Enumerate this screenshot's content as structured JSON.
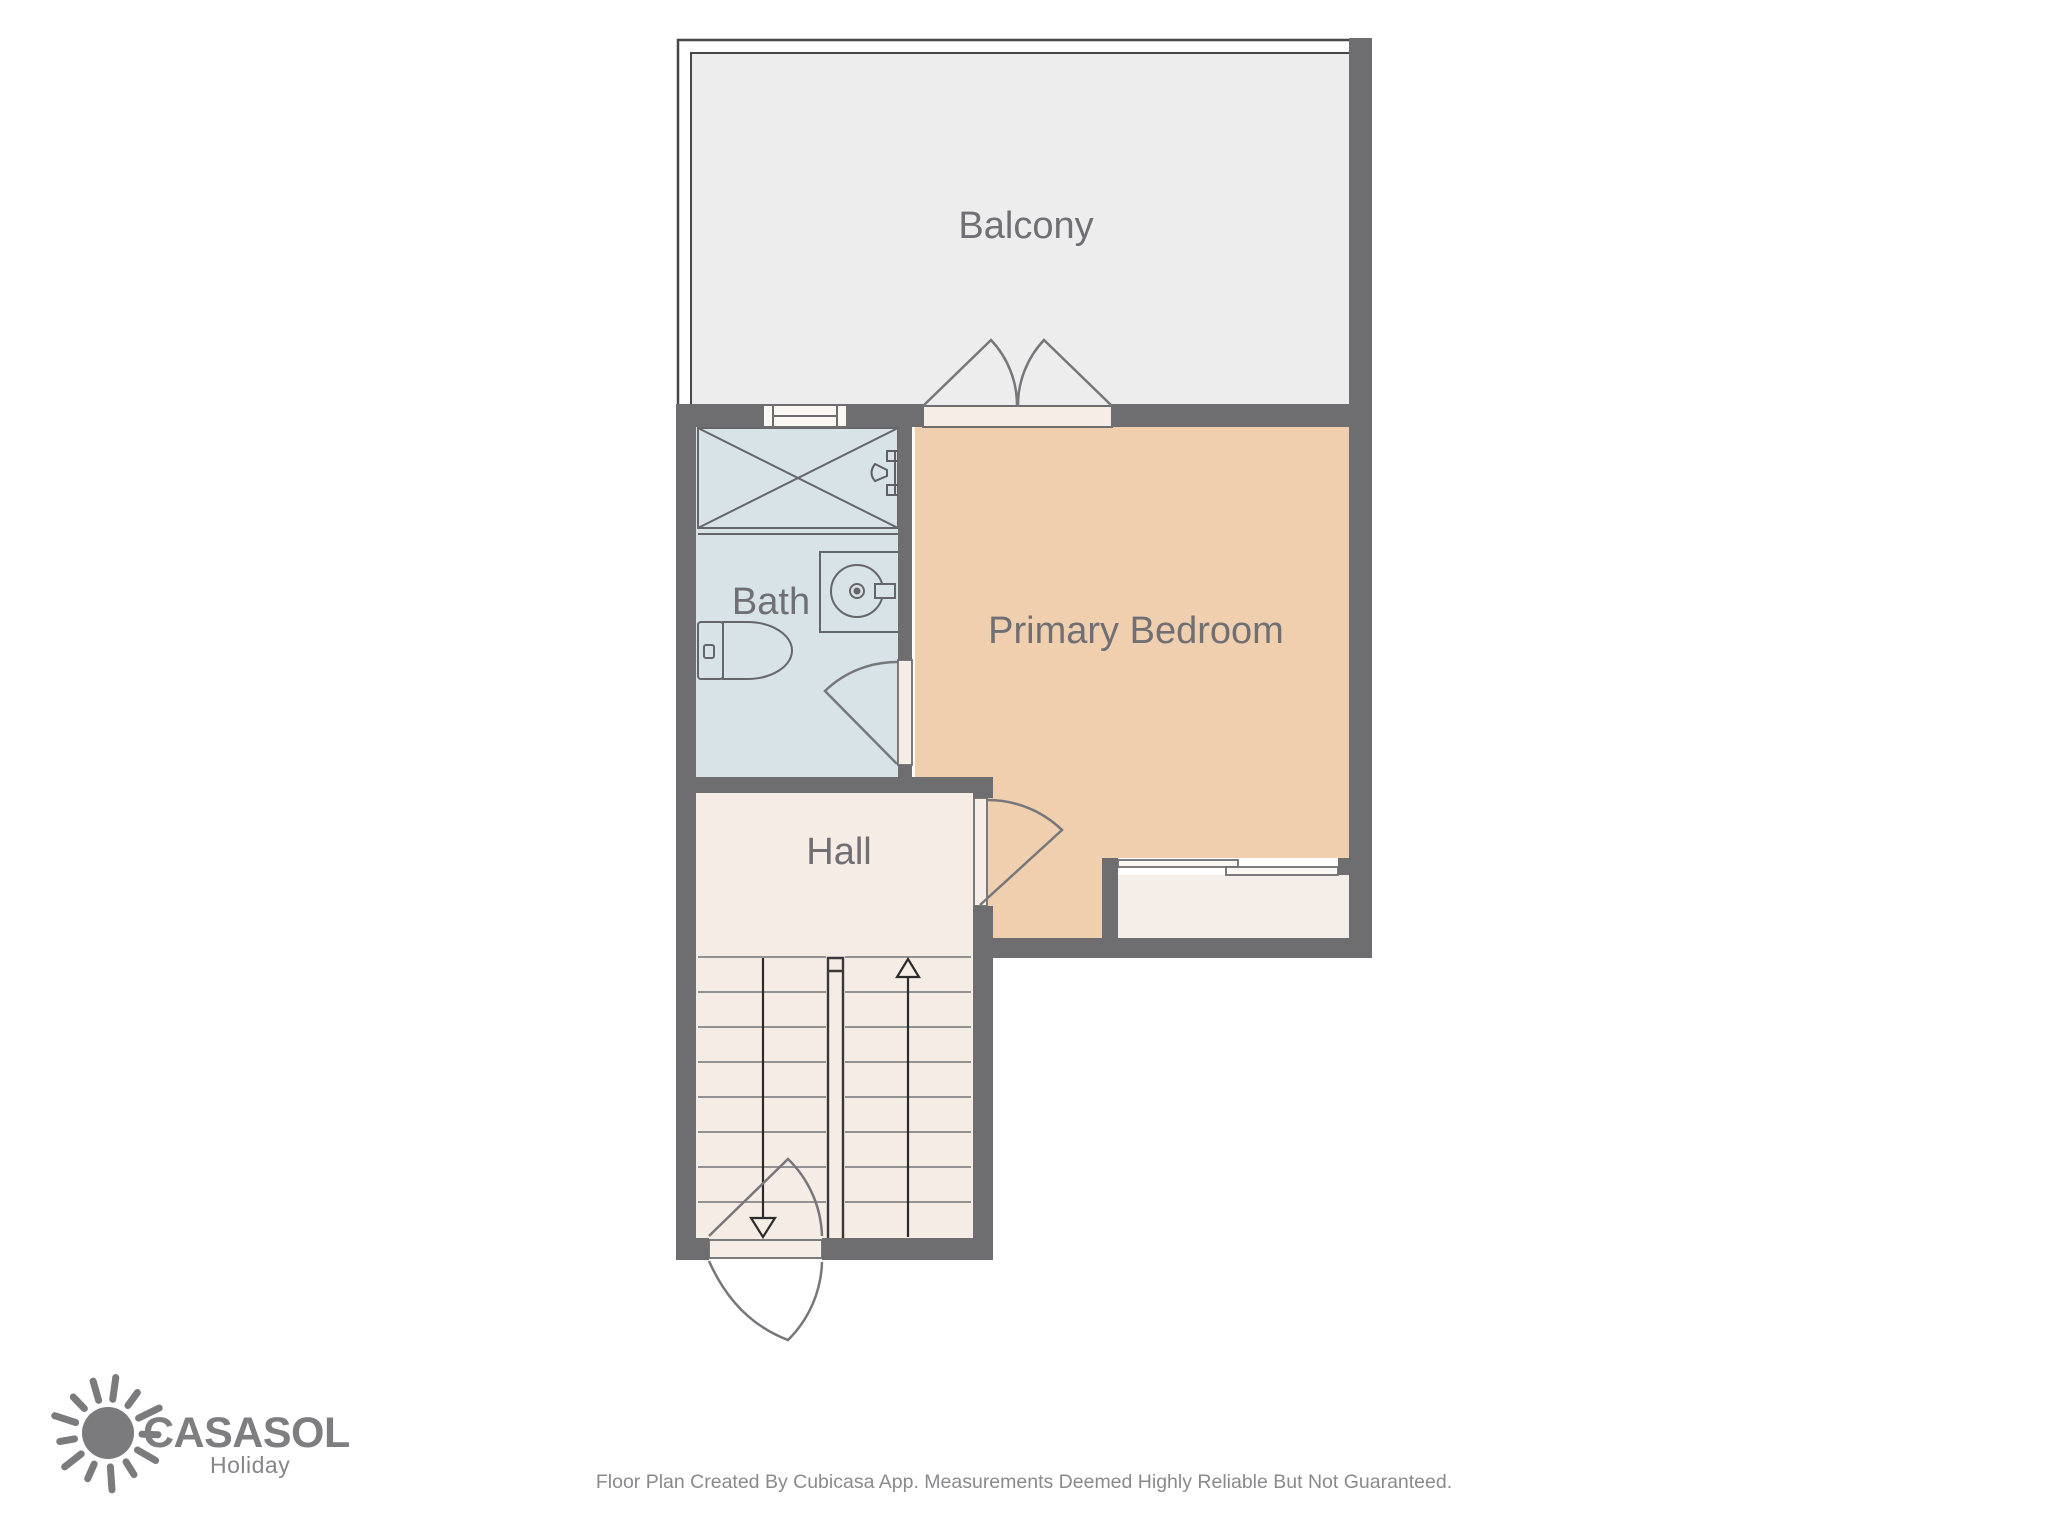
{
  "floor_plan": {
    "rooms": {
      "balcony": {
        "label": "Balcony",
        "fill": "#ededed"
      },
      "bath": {
        "label": "Bath",
        "fill": "#d7e3e6"
      },
      "hall": {
        "label": "Hall",
        "fill": "#f5ece5"
      },
      "primary_bedroom": {
        "label": "Primary Bedroom",
        "fill": "#f0cfae"
      }
    },
    "colors": {
      "wall": "#6e6e70",
      "balcony_outline": "#47474a",
      "door_sill": "#f5ede6",
      "door_arc": "#77777b",
      "stair_tread_line": "#929295",
      "stair_rail_and_arrows": "#39393b",
      "window_fill": "#fbf7f2",
      "label_text": "#6f6f74"
    },
    "symbols": [
      "shower",
      "shower-faucet",
      "sink",
      "toilet",
      "window",
      "french-doors",
      "sliding-window",
      "door-swing",
      "stairs-up-arrow",
      "stairs-down-arrow",
      "stair-railing"
    ]
  },
  "branding": {
    "name": "CASASOL",
    "tagline": "Holiday",
    "logo_color": "#7b7b7d",
    "icon": "sun-icon"
  },
  "footer": {
    "disclaimer": "Floor Plan Created By Cubicasa App. Measurements Deemed Highly Reliable But Not Guaranteed."
  }
}
